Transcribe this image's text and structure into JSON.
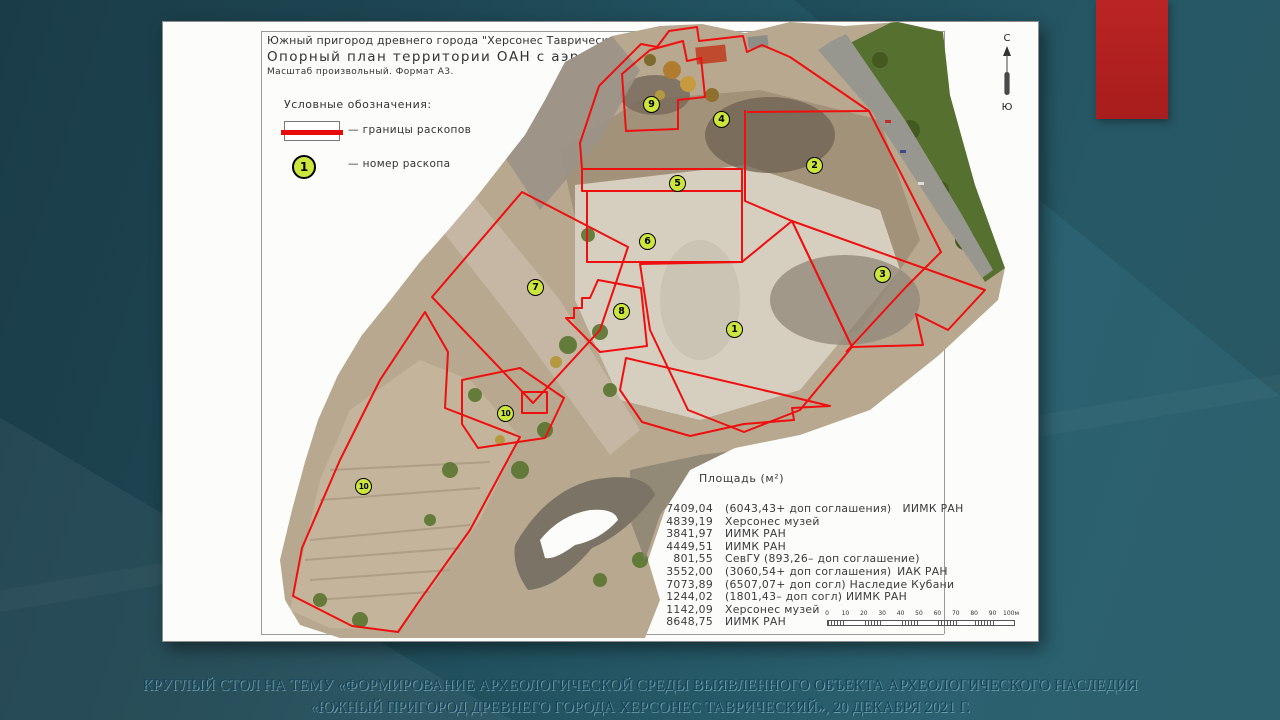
{
  "colors": {
    "accent_rect": "#b32222",
    "boundary_red": "#ef0f0f",
    "marker_fill": "#cde63e"
  },
  "map": {
    "title_line1": "Южный пригород древнего города \"Херсонес Таврический\" – 2021.",
    "title_line2": "Опорный план территории ОАН с аэрофотосъемкой.",
    "title_line3": "Масштаб произвольный. Формат А3.",
    "legend": {
      "heading": "Условные обозначения:",
      "boundary_label": "—  границы раскопов",
      "number_label": "—  номер раскопа",
      "number_sample": "1"
    },
    "compass": {
      "north": "С",
      "south": "Ю"
    },
    "table": {
      "header_col1": "Участок",
      "header_col2": "Площадь (м²)",
      "rows": [
        {
          "num": "1",
          "area": "7409,04",
          "rest": "(6043,43+ доп соглашения) ИИМК РАН"
        },
        {
          "num": "2",
          "area": "4839,19",
          "rest": "Херсонес музей"
        },
        {
          "num": "3",
          "area": "3841,97",
          "rest": "ИИМК РАН"
        },
        {
          "num": "4",
          "area": "4449,51",
          "rest": "ИИМК РАН"
        },
        {
          "num": "5",
          "area": "801,55",
          "rest": "СевГУ (893,26– доп соглашение)"
        },
        {
          "num": "6",
          "area": "3552,00",
          "rest": "(3060,54+ доп соглашения) ИАК РАН"
        },
        {
          "num": "7",
          "area": "7073,89",
          "rest": "(6507,07+ доп согл) Наследие Кубани"
        },
        {
          "num": "8",
          "area": "1244,02",
          "rest": "(1801,43– доп согл) ИИМК РАН"
        },
        {
          "num": "9",
          "area": "1142,09",
          "rest": "Херсонес музей"
        },
        {
          "num": "10",
          "area": "8648,75",
          "rest": "ИИМК РАН"
        }
      ]
    },
    "scalebar_ticks": [
      "0",
      "10",
      "20",
      "30",
      "40",
      "50",
      "60",
      "70",
      "80",
      "90",
      "100м"
    ],
    "markers": [
      {
        "n": "9",
        "x": 652,
        "y": 105
      },
      {
        "n": "4",
        "x": 722,
        "y": 120
      },
      {
        "n": "2",
        "x": 815,
        "y": 166
      },
      {
        "n": "5",
        "x": 678,
        "y": 184
      },
      {
        "n": "6",
        "x": 648,
        "y": 242
      },
      {
        "n": "3",
        "x": 883,
        "y": 275
      },
      {
        "n": "7",
        "x": 536,
        "y": 288
      },
      {
        "n": "8",
        "x": 622,
        "y": 312
      },
      {
        "n": "1",
        "x": 735,
        "y": 330
      },
      {
        "n": "10",
        "x": 506,
        "y": 414
      },
      {
        "n": "10",
        "x": 364,
        "y": 487
      }
    ]
  },
  "caption": {
    "line1": "КРУГЛЫЙ СТОЛ НА ТЕМУ «ФОРМИРОВАНИЕ АРХЕОЛОГИЧЕСКОЙ СРЕДЫ ВЫЯВЛЕННОГО ОБЪЕКТА АРХЕОЛОГИЧЕСКОГО НАСЛЕДИЯ",
    "line2": "«ЮЖНЫЙ ПРИГОРОД ДРЕВНЕГО ГОРОДА ХЕРСОНЕС ТАВРИЧЕСКИЙ», 20 ДЕКАБРЯ 2021 Г."
  }
}
